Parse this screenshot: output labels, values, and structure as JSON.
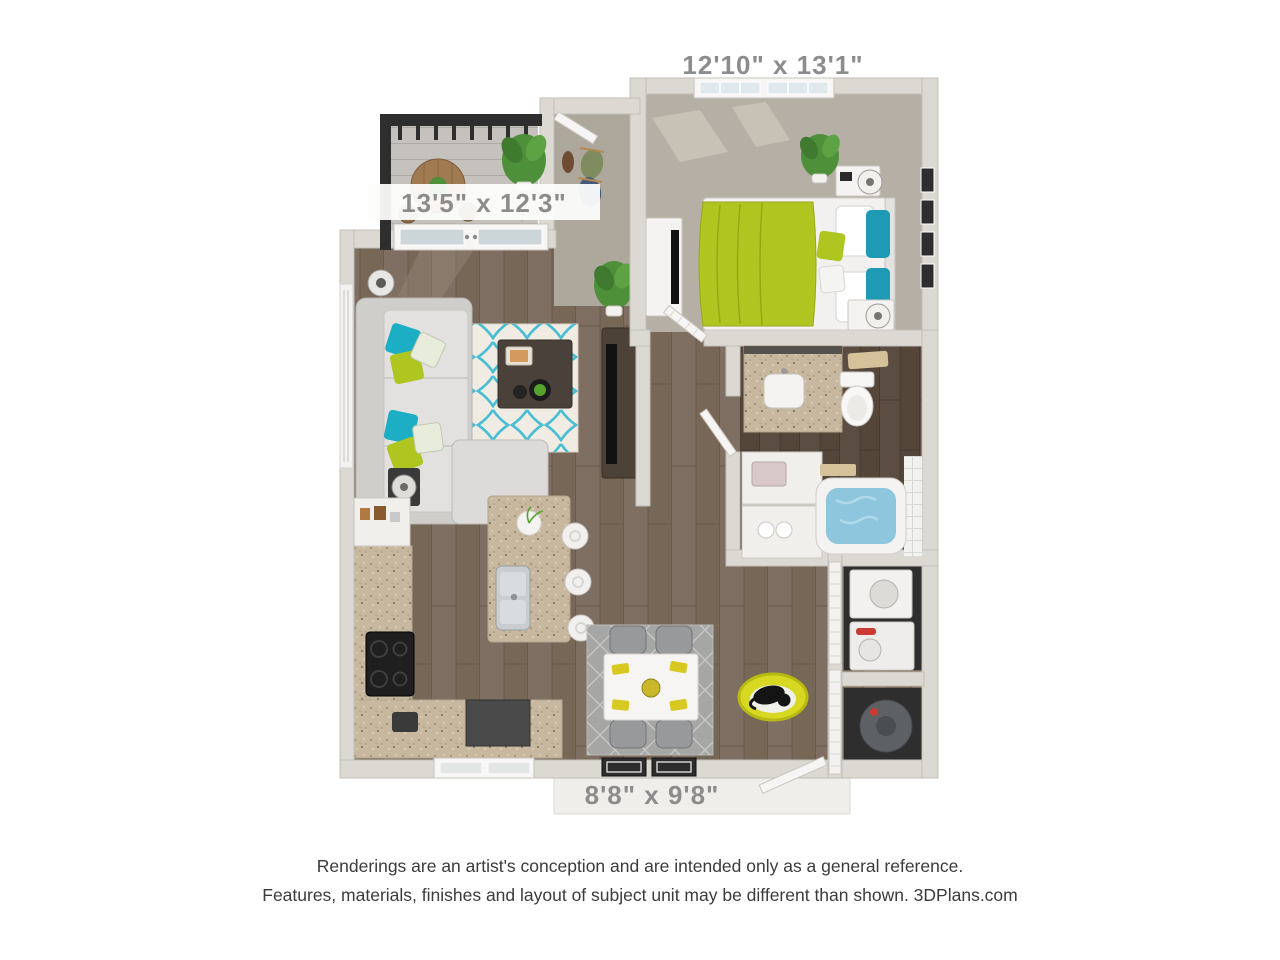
{
  "labels": {
    "bedroom": "12'10\" x 13'1\"",
    "living": "13'5\" x 12'3\"",
    "patio": "8'8\" x 9'8\""
  },
  "footer": {
    "line1": "Renderings are an artist's conception and are intended only as a general reference.",
    "line2": "Features, materials, finishes and layout of subject unit may be different than shown. 3DPlans.com"
  },
  "palette": {
    "wall": "#dcd9d3",
    "wall_edge": "#c2bfb9",
    "wood_floor": "#7d6e61",
    "wood_floor_dark": "#5a4c41",
    "carpet_bedroom": "#b6afa5",
    "carpet_entry": "#aea79b",
    "balcony_floor": "#c5c2bd",
    "rug_cream": "#f0ebe3",
    "rug_teal": "#49bed2",
    "dining_rug": "#a6a6a4",
    "accent_lime": "#aec61f",
    "accent_teal": "#1caec4",
    "accent_yellow": "#d6d822",
    "granite": "#c8b89f",
    "tub_water": "#8ec6dd",
    "railing": "#2e2e2e",
    "sofa": "#dcdbd9",
    "furniture_dark": "#4a4238",
    "dim_text": "#8c8c8c",
    "footer_text": "#3b3b3b"
  }
}
